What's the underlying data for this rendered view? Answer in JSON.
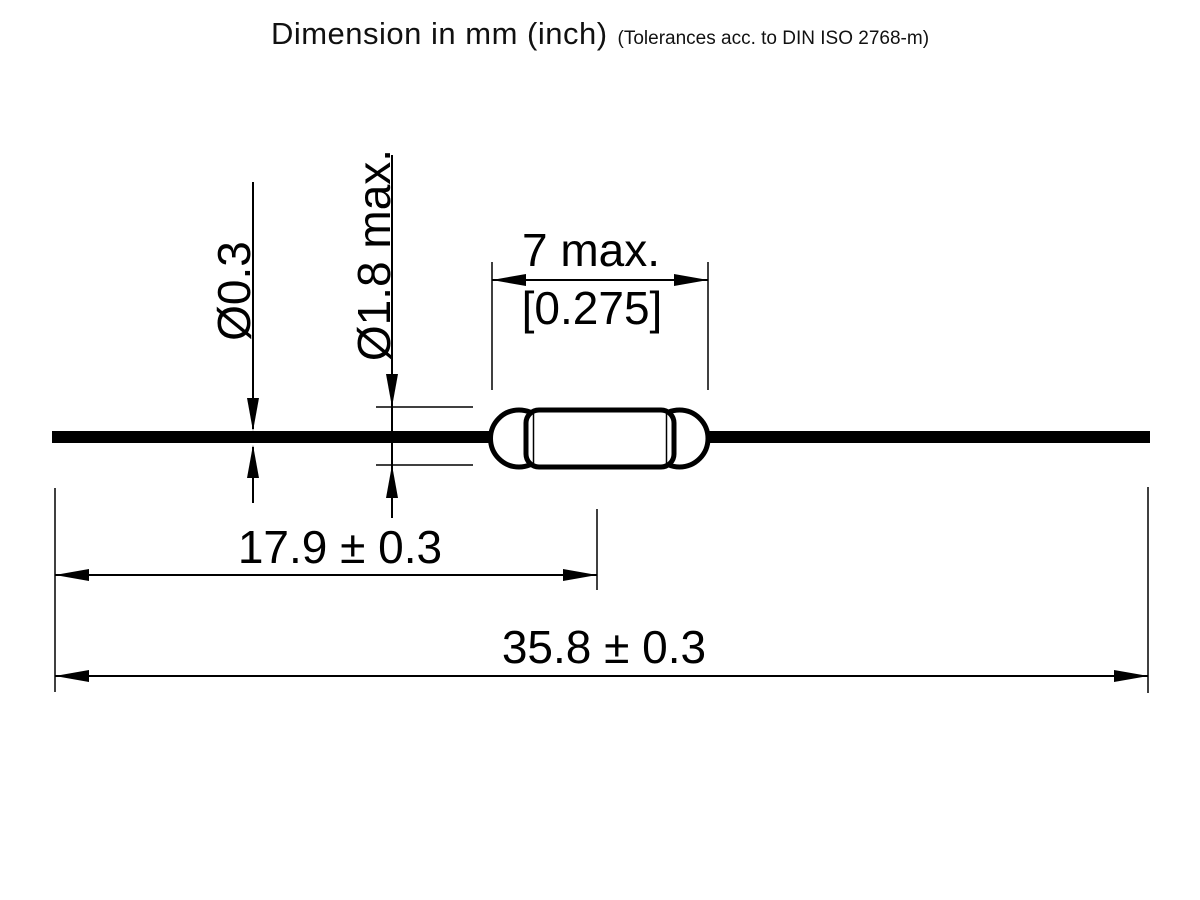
{
  "title": {
    "main": "Dimension in mm (inch)",
    "note": "(Tolerances acc. to DIN ISO 2768-m)"
  },
  "dimensions": {
    "lead_diameter": "Ø0.3",
    "glass_diameter": "Ø1.8 max.",
    "glass_length_mm": "7 max.",
    "glass_length_inch": "[0.275]",
    "lead_end_to_glass_center": "17.9 ± 0.3",
    "overall_length": "35.8 ± 0.3"
  },
  "component": {
    "name": "reed-switch-outline-drawing"
  },
  "colors": {
    "ink": "#000000",
    "background": "#ffffff"
  }
}
